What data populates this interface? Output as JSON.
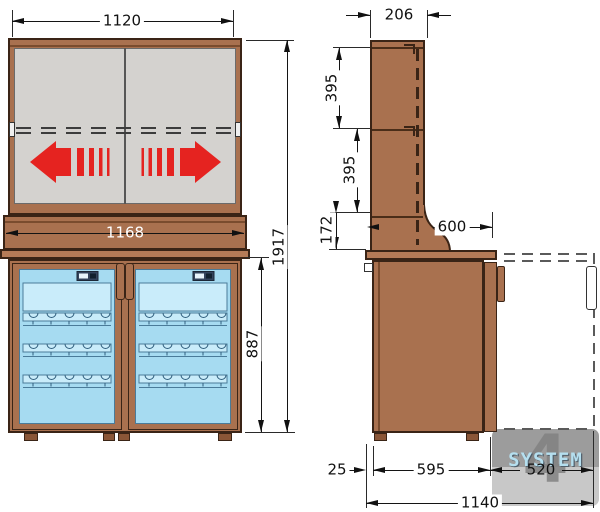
{
  "drawing_type": "furniture technical drawing, front and side elevations with dimensions",
  "front_view": {
    "label": "front-elevation",
    "dim_top_width": "1120",
    "dim_counter_width": "1168",
    "dim_total_height": "1917",
    "dim_lower_height": "887"
  },
  "side_view": {
    "label": "side-elevation",
    "dim_top_depth": "206",
    "dim_upper_section_a": "395",
    "dim_upper_section_b": "395",
    "dim_upper_section_c": "172",
    "dim_counter_depth": "600",
    "dim_rear_overhang": "25",
    "dim_body_depth": "595",
    "dim_door_swing": "520",
    "dim_total_depth": "1140"
  },
  "watermark": {
    "numeral": "4",
    "text": "SYSTEM"
  },
  "icons": {
    "slide_left": "slide-direction-left-arrow",
    "slide_right": "slide-direction-right-arrow"
  },
  "colors": {
    "wood": "#a9714f",
    "wood_dark": "#7a4c2e",
    "outline": "#3a2416",
    "door_gray": "#d4d2cf",
    "arrow_red": "#e52320",
    "glass_blue": "#a6dbf1",
    "glass_light": "#c9ecfa",
    "dimension": "#111111",
    "watermark_gray": "#9c9c9c",
    "watermark_text": "#b5dfef"
  }
}
